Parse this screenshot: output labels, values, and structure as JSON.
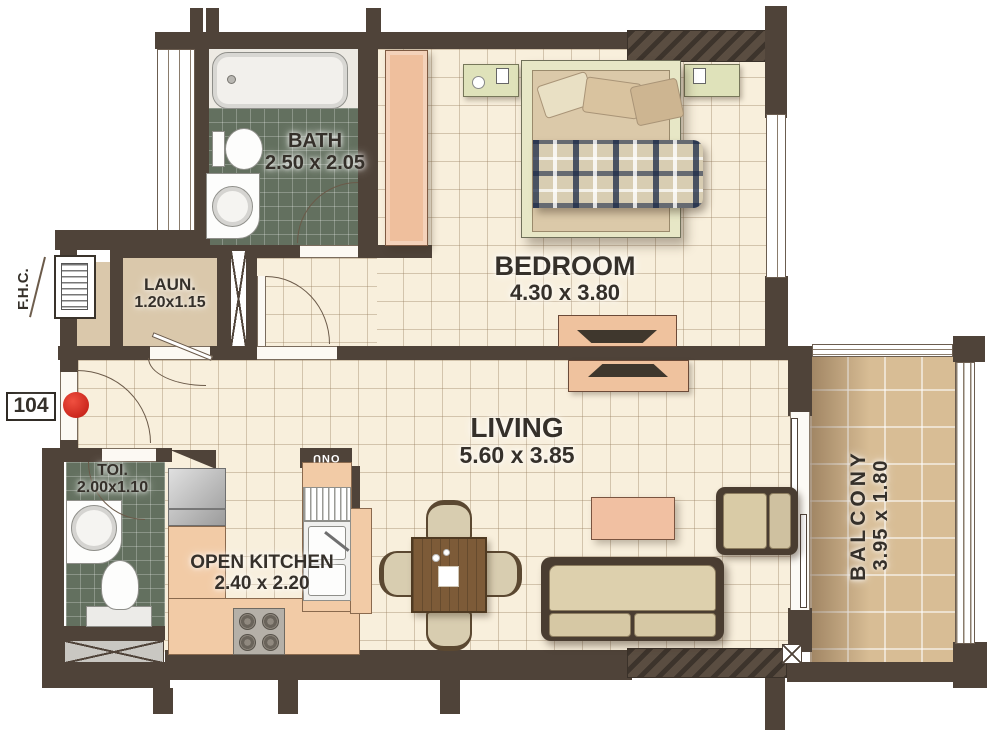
{
  "plan": {
    "unit_number": "104",
    "fhc_label": "F.H.C.",
    "onu_label": "ONU"
  },
  "rooms": {
    "bath": {
      "name": "BATH",
      "dims": "2.50 x 2.05"
    },
    "bedroom": {
      "name": "BEDROOM",
      "dims": "4.30 x 3.80"
    },
    "laundry": {
      "name": "LAUN.",
      "dims": "1.20x1.15"
    },
    "toilet": {
      "name": "TOI.",
      "dims": "2.00x1.10"
    },
    "kitchen": {
      "name": "OPEN KITCHEN",
      "dims": "2.40 x 2.20"
    },
    "living": {
      "name": "LIVING",
      "dims": "5.60 x 3.85"
    },
    "balcony": {
      "name": "BALCONY",
      "dims": "3.95 x 1.80"
    }
  },
  "colors": {
    "wall": "#4f4339",
    "floor-cream": "#f8efdc",
    "tile-green": "#63705f",
    "floor-tan": "#dac8ab",
    "balcony-tan": "#d8bd95",
    "counter-peach": "#f2cba6",
    "furniture-beige": "#d9cba6",
    "furniture-dark": "#4a3d31",
    "accent-red": "#e12f27",
    "label-ink": "#35302a"
  }
}
